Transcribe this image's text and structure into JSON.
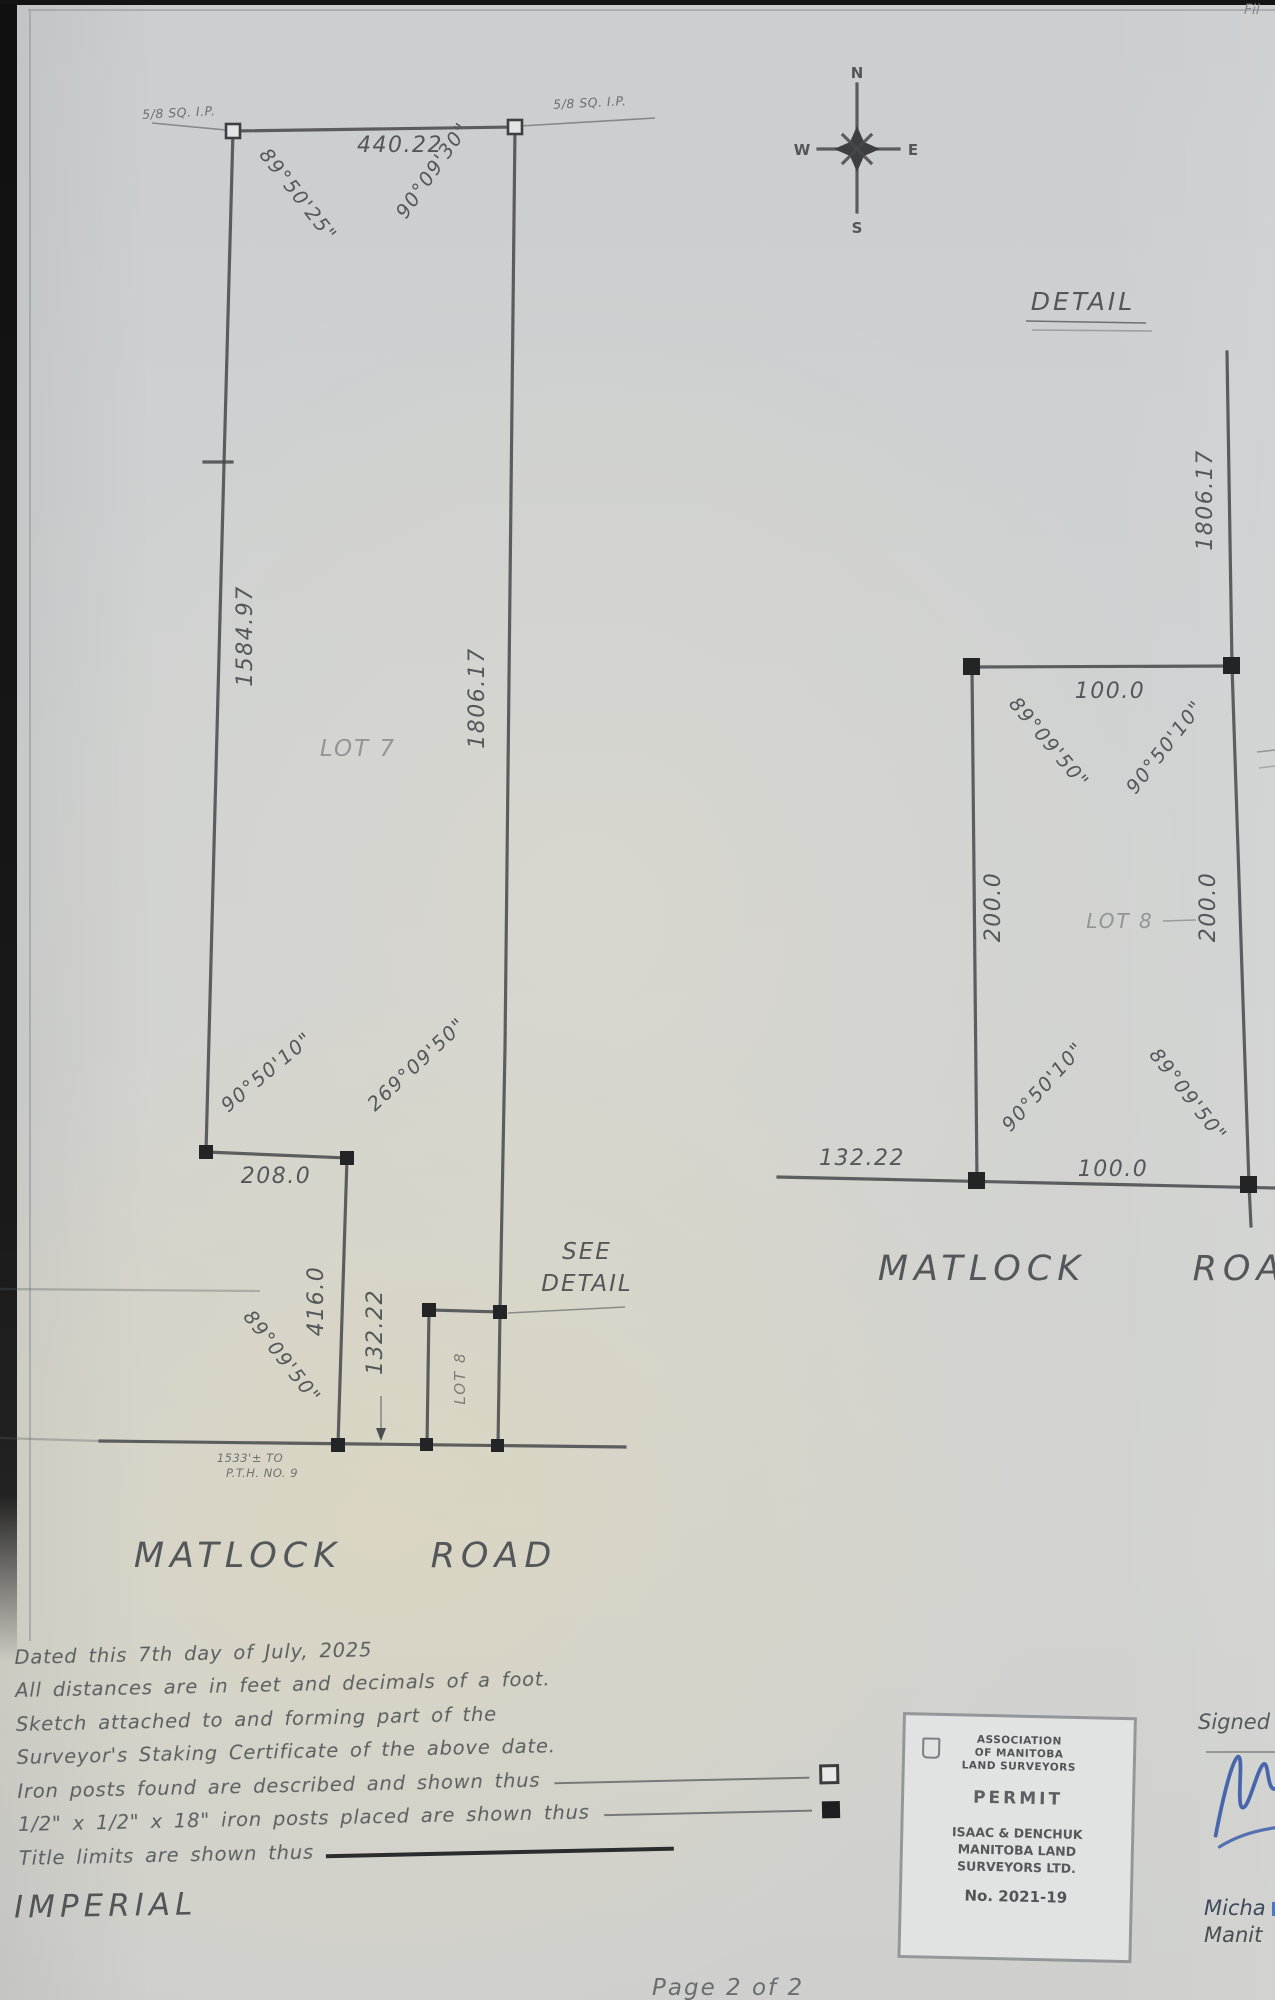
{
  "scan": {
    "corner_note": "Fil"
  },
  "compass": {
    "north": "N",
    "south": "S",
    "east": "E",
    "west": "W"
  },
  "main_plot": {
    "monument_nw": "5/8 SQ. I.P.",
    "monument_ne": "5/8 SQ. I.P.",
    "top_distance": "440.22",
    "bearing_nw": "89°50'25\"",
    "bearing_ne": "90°09'30\"",
    "west_distance": "1584.97",
    "east_distance": "1806.17",
    "lot7_label": "LOT 7",
    "bearing_jog_west": "90°50'10\"",
    "bearing_jog_east": "269°09'50\"",
    "jog_distance": "208.0",
    "lot8_west_distance": "416.0",
    "lot8_frontage": "132.22",
    "lot8_label": "LOT 8",
    "bearing_sw": "89°09'50\"",
    "see_detail_line1": "SEE",
    "see_detail_line2": "DETAIL",
    "pth_note_line1": "1533'± TO",
    "pth_note_line2": "P.T.H. NO. 9",
    "road_word1": "MATLOCK",
    "road_word2": "ROAD"
  },
  "detail_view": {
    "heading": "DETAIL",
    "east_approach_distance": "1806.17",
    "north_distance": "100.0",
    "south_distance": "100.0",
    "west_distance": "200.0",
    "east_distance": "200.0",
    "lot8_label": "LOT 8",
    "bearing_nw": "89°09'50\"",
    "bearing_ne": "90°50'10\"",
    "bearing_sw": "90°50'10\"",
    "bearing_se": "89°09'50\"",
    "road_west_distance": "132.22",
    "road_word1": "MATLOCK",
    "road_word2": "ROAD"
  },
  "notes": {
    "dated": "Dated this 7th day of July, 2025",
    "distances": "All distances are in feet and decimals of a foot.",
    "sketch1": "Sketch attached to and forming part of the",
    "sketch2": "Surveyor's Staking Certificate of the above date.",
    "found": "Iron posts found are described and shown thus",
    "placed": "1/2\" x 1/2\" x 18\" iron posts placed are shown thus",
    "title_limits": "Title limits are shown thus",
    "units": "IMPERIAL"
  },
  "stamp": {
    "assoc1": "ASSOCIATION",
    "assoc2": "OF MANITOBA",
    "assoc3": "LAND SURVEYORS",
    "permit": "PERMIT",
    "firm1": "ISAAC & DENCHUK",
    "firm2": "MANITOBA LAND",
    "firm3": "SURVEYORS LTD.",
    "number": "No. 2021-19"
  },
  "signature": {
    "label": "Signed",
    "name_partial": "Micha",
    "affil_partial": "Manit"
  },
  "footer": {
    "page_label": "Page 2 of 2"
  }
}
